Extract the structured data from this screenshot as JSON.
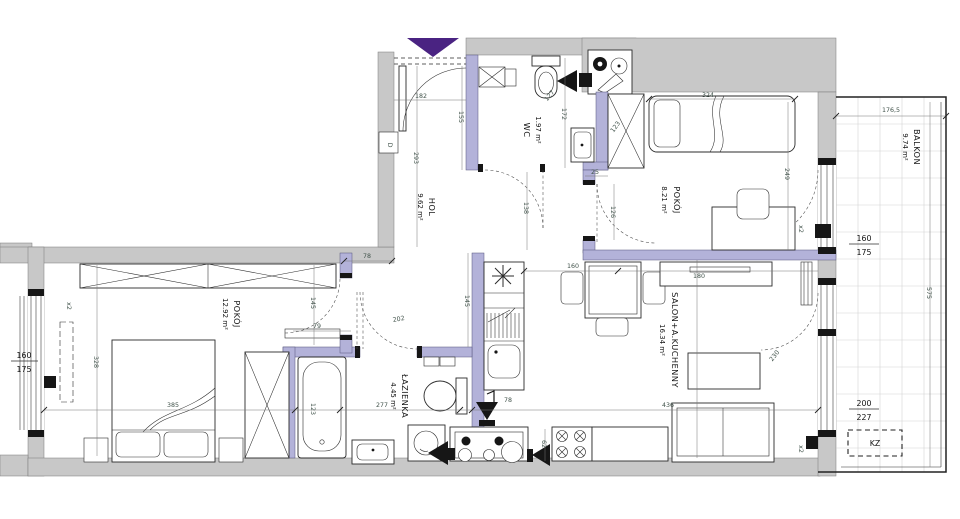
{
  "plan_type": "apartment-floor-plan",
  "rooms": {
    "hol": {
      "name": "HOL",
      "area": "9.62 m²"
    },
    "wc": {
      "name": "WC",
      "area": "1.97 m²"
    },
    "bedroom2": {
      "name": "POKÓJ",
      "area": "8.21 m²"
    },
    "balcony": {
      "name": "BALKON",
      "area": "9.74 m²"
    },
    "livingroom": {
      "name": "SALON+A.KUCHENNY",
      "area": "16.34 m²"
    },
    "bathroom": {
      "name": "ŁAZIENKA",
      "area": "4.45 m²"
    },
    "bedroom1": {
      "name": "POKÓJ",
      "area": "12.92 m²"
    }
  },
  "dims": {
    "hall_width": "182",
    "hall_seg1": "155",
    "hall_left_height": "293",
    "hall_seg2": "138",
    "hall_door": "78",
    "corridor_left": "145",
    "bedroom1_door": "79",
    "corridor_width": "202",
    "kitchen_wall": "145",
    "bathroom_width": "277",
    "bedroom1_width": "385",
    "bedroom1_height": "328",
    "bathtub": "123",
    "wc_height": "172",
    "wc_toilet_offset": "127",
    "wc_step": "25",
    "bedroom2_door": "126",
    "bedroom2_wardrobe": "123",
    "bedroom2_bed": "324",
    "bedroom2_height": "249",
    "kitchen_width": "160",
    "kitchen_passage": "78",
    "stove_width": "62",
    "livingroom_width": "436",
    "balcony_door_swing": "230",
    "sideboard": "180",
    "balcony_width": "176,5",
    "balcony_depth": "575"
  },
  "windows": {
    "left_window_w": "160",
    "left_window_h": "175",
    "left_window_count": "x2",
    "bedroom2_window_count": "x2",
    "livingroom_window_count": "x2",
    "balcony_window_w": "160",
    "balcony_window_h": "175",
    "balcony_door_w": "200",
    "balcony_door_h": "227"
  },
  "annotations": {
    "shaft_box": "KZ",
    "door_box": "D"
  },
  "colors": {
    "structural_wall": "#c8c8c8",
    "partition_wall": "#b3b2d9",
    "entry_arrow": "#4a2382",
    "line": "#2b2b2b",
    "dimension_text": "#40524a"
  }
}
